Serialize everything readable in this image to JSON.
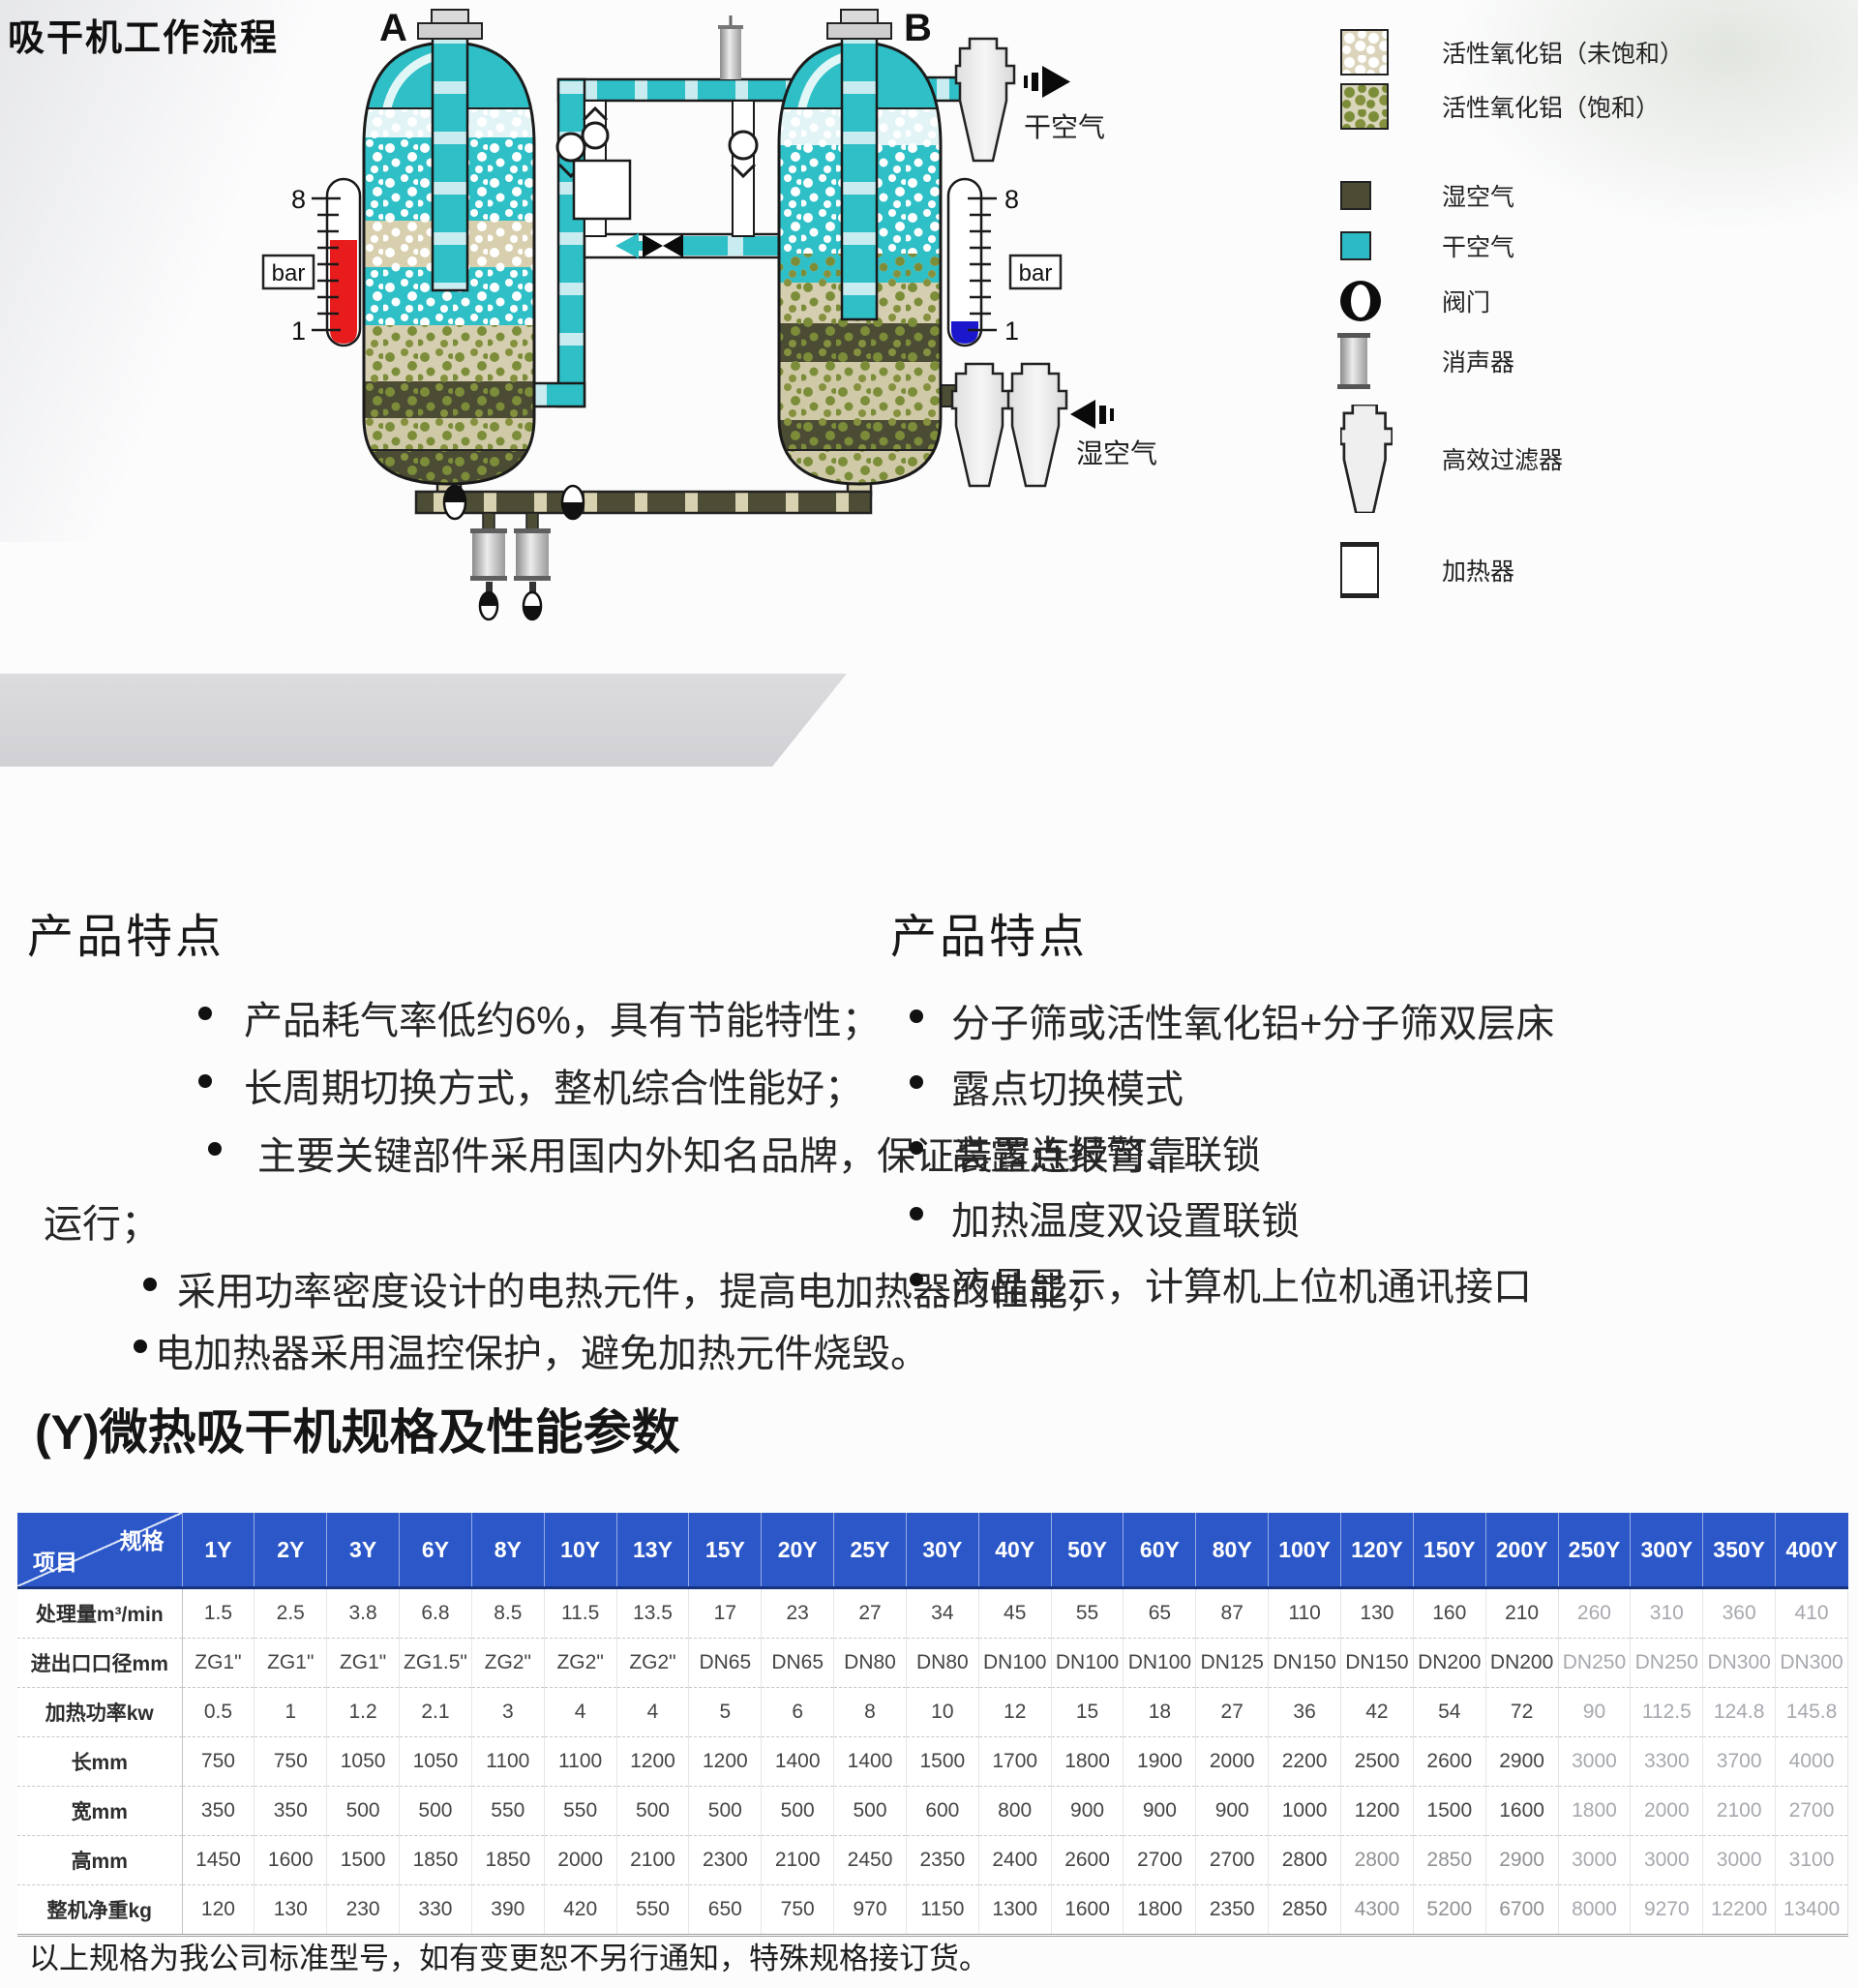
{
  "page": {
    "title": "吸干机工作流程",
    "section2_title": "(Y)微热吸干机规格及性能参数",
    "footnote": "以上规格为我公司标准型号，如有变更恕不另行通知，特殊规格接订货。"
  },
  "diagram": {
    "tower_a": "A",
    "tower_b": "B",
    "gauge_unit": "bar",
    "gauge_max": "8",
    "gauge_min": "1",
    "dry_air": "干空气",
    "wet_air": "湿空气",
    "colors": {
      "dry_air": "#2fbfc6",
      "dry_air_light": "#c9ecf1",
      "wet_air": "#4d4d35",
      "alumina_beige": "#d8cfae",
      "gauge_red": "#e81c1c",
      "gauge_blue": "#1b17cc",
      "table_header_blue": "#2b57c8"
    }
  },
  "legend": {
    "items": [
      {
        "icon": "alumina-unsaturated-swatch",
        "label": "活性氧化铝（未饱和）"
      },
      {
        "icon": "alumina-saturated-swatch",
        "label": "活性氧化铝（饱和）"
      },
      {
        "icon": "wet-air-swatch",
        "label": "湿空气"
      },
      {
        "icon": "dry-air-swatch",
        "label": "干空气"
      },
      {
        "icon": "valve-icon",
        "label": "阀门"
      },
      {
        "icon": "muffler-icon",
        "label": "消声器"
      },
      {
        "icon": "filter-icon",
        "label": "高效过滤器"
      },
      {
        "icon": "heater-icon",
        "label": "加热器"
      }
    ]
  },
  "features_left": {
    "heading": "产品特点",
    "items": [
      "产品耗气率低约6%，具有节能特性；",
      "长周期切换方式，整机综合性能好；",
      "主要关键部件采用国内外知名品牌，保证装置连续可靠",
      "采用功率密度设计的电热元件，提高电加热器的性能；",
      "电加热器采用温控保护，避免加热元件烧毁。"
    ],
    "continuation": "运行；"
  },
  "features_right": {
    "heading": "产品特点",
    "items": [
      "分子筛或活性氧化铝+分子筛双层床",
      "露点切换模式",
      "高露点报警、联锁",
      "加热温度双设置联锁",
      "液晶显示，计算机上位机通讯接口"
    ]
  },
  "table": {
    "corner_top": "规格",
    "corner_bottom": "项目",
    "columns": [
      "1Y",
      "2Y",
      "3Y",
      "6Y",
      "8Y",
      "10Y",
      "13Y",
      "15Y",
      "20Y",
      "25Y",
      "30Y",
      "40Y",
      "50Y",
      "60Y",
      "80Y",
      "100Y",
      "120Y",
      "150Y",
      "200Y",
      "250Y",
      "300Y",
      "350Y",
      "400Y"
    ],
    "rows": [
      {
        "label": "处理量m³/min",
        "values": [
          "1.5",
          "2.5",
          "3.8",
          "6.8",
          "8.5",
          "11.5",
          "13.5",
          "17",
          "23",
          "27",
          "34",
          "45",
          "55",
          "65",
          "87",
          "110",
          "130",
          "160",
          "210",
          "260",
          "310",
          "360",
          "410"
        ]
      },
      {
        "label": "进出口口径mm",
        "values": [
          "ZG1\"",
          "ZG1\"",
          "ZG1\"",
          "ZG1.5\"",
          "ZG2\"",
          "ZG2\"",
          "ZG2\"",
          "DN65",
          "DN65",
          "DN80",
          "DN80",
          "DN100",
          "DN100",
          "DN100",
          "DN125",
          "DN150",
          "DN150",
          "DN200",
          "DN200",
          "DN250",
          "DN250",
          "DN300",
          "DN300"
        ]
      },
      {
        "label": "加热功率kw",
        "values": [
          "0.5",
          "1",
          "1.2",
          "2.1",
          "3",
          "4",
          "4",
          "5",
          "6",
          "8",
          "10",
          "12",
          "15",
          "18",
          "27",
          "36",
          "42",
          "54",
          "72",
          "90",
          "112.5",
          "124.8",
          "145.8"
        ]
      },
      {
        "label": "长mm",
        "values": [
          "750",
          "750",
          "1050",
          "1050",
          "1100",
          "1100",
          "1200",
          "1200",
          "1400",
          "1400",
          "1500",
          "1700",
          "1800",
          "1900",
          "2000",
          "2200",
          "2500",
          "2600",
          "2900",
          "3000",
          "3300",
          "3700",
          "4000"
        ]
      },
      {
        "label": "宽mm",
        "values": [
          "350",
          "350",
          "500",
          "500",
          "550",
          "550",
          "500",
          "500",
          "500",
          "500",
          "600",
          "800",
          "900",
          "900",
          "900",
          "1000",
          "1200",
          "1500",
          "1600",
          "1800",
          "2000",
          "2100",
          "2700"
        ]
      },
      {
        "label": "高mm",
        "values": [
          "1450",
          "1600",
          "1500",
          "1850",
          "1850",
          "2000",
          "2100",
          "2300",
          "2100",
          "2450",
          "2350",
          "2400",
          "2600",
          "2700",
          "2700",
          "2800",
          "2800",
          "2850",
          "2900",
          "3000",
          "3000",
          "3000",
          "3100"
        ]
      },
      {
        "label": "整机净重kg",
        "values": [
          "120",
          "130",
          "230",
          "330",
          "390",
          "420",
          "550",
          "650",
          "750",
          "970",
          "1150",
          "1300",
          "1600",
          "1800",
          "2350",
          "2850",
          "4300",
          "5200",
          "6700",
          "8000",
          "9270",
          "12200",
          "13400"
        ]
      }
    ]
  }
}
